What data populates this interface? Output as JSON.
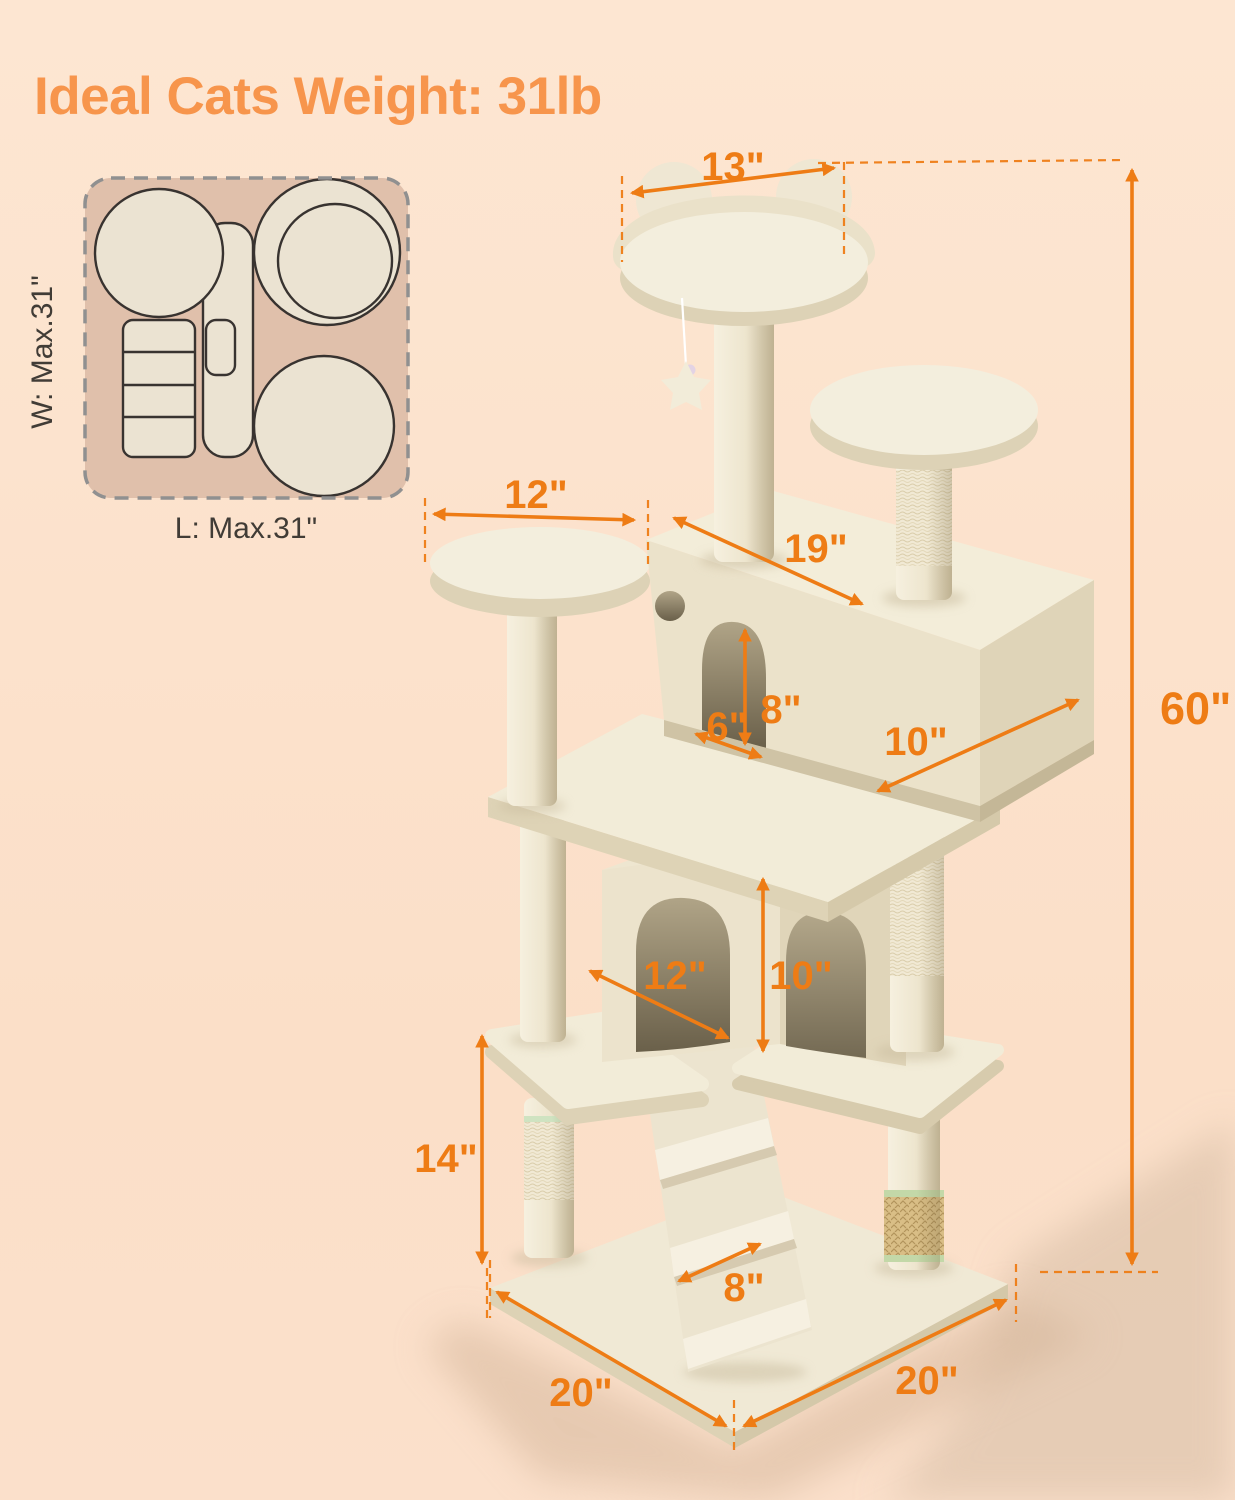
{
  "title": "Ideal Cats Weight: 31lb",
  "top_view": {
    "width_label": "W: Max.31\"",
    "length_label": "L: Max.31\""
  },
  "dimensions": {
    "top_platform_width": "13\"",
    "upper_platform_diameter": "12\"",
    "condo_length": "19\"",
    "entrance_width": "6\"",
    "entrance_height": "8\"",
    "condo_depth": "10\"",
    "lower_condo_width": "12\"",
    "lower_condo_height": "10\"",
    "scratching_post_height": "14\"",
    "ramp_width": "8\"",
    "base_side_left": "20\"",
    "base_side_right": "20\"",
    "total_height": "60\""
  },
  "colors": {
    "background": "#fce3cd",
    "dimension_orange": "#ee7c15",
    "title_orange": "#f7954c",
    "plush_cream": "#f2ecd8",
    "top_view_panel": "#e0c0ab"
  }
}
